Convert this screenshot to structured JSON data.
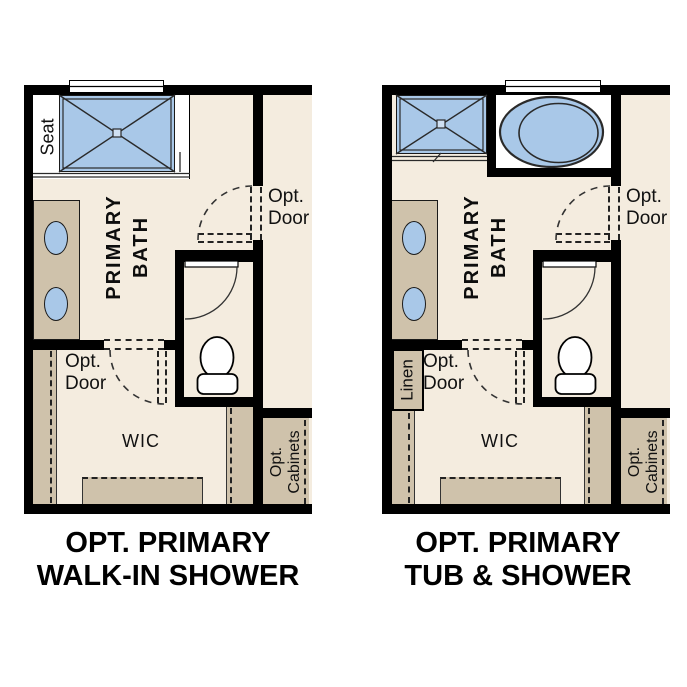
{
  "sheet": {
    "type": "floor-plan-options",
    "room": "Primary Bath"
  },
  "colors": {
    "wall": "#000000",
    "floor_beige": "#f4ecdf",
    "fixture_blue": "#a9c8e8",
    "cabinet_tan": "#cfc2ab",
    "fixture_white": "#ffffff",
    "stroke": "#2a2a2a"
  },
  "plans": {
    "left": {
      "title1": "OPT. PRIMARY",
      "title2": "WALK-IN SHOWER",
      "seat": "Seat",
      "room1": "PRIMARY",
      "room2": "BATH",
      "opt": "Opt.",
      "door": "Door",
      "wic": "WIC",
      "cab1": "Opt.",
      "cab2": "Cabinets"
    },
    "right": {
      "title1": "OPT. PRIMARY",
      "title2": "TUB & SHOWER",
      "room1": "PRIMARY",
      "room2": "BATH",
      "opt": "Opt.",
      "door": "Door",
      "linen": "Linen",
      "wic": "WIC",
      "cab1": "Opt.",
      "cab2": "Cabinets"
    }
  }
}
